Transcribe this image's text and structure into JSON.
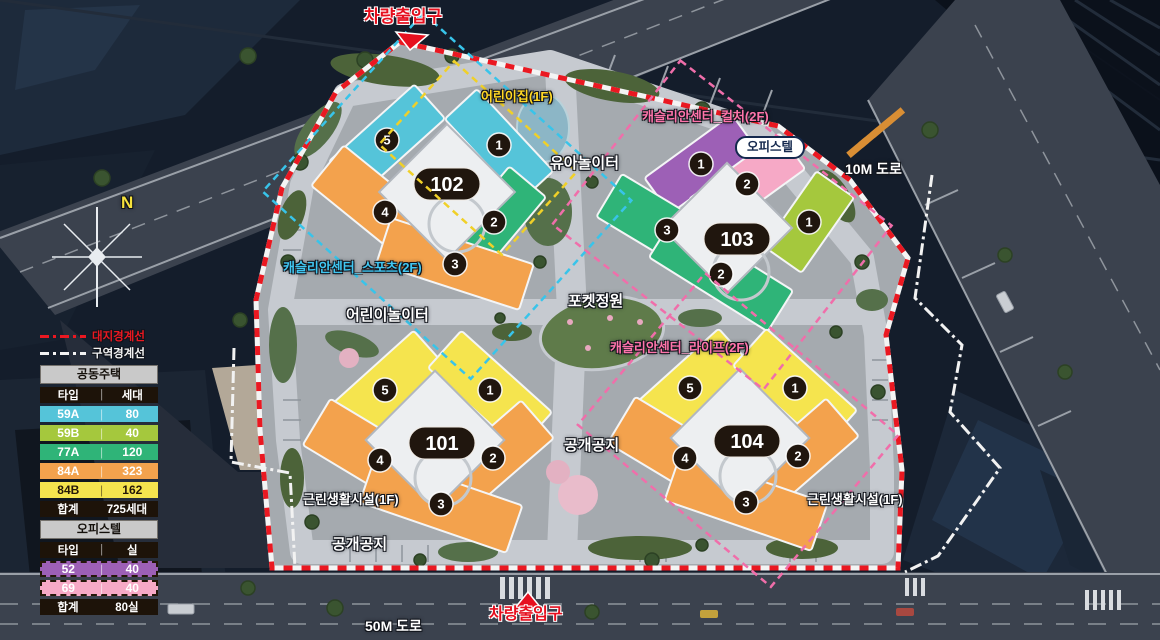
{
  "colors": {
    "type_59A": "#55c4d9",
    "type_59B": "#a5c83d",
    "type_77A": "#2fb478",
    "type_84A": "#f3a24d",
    "type_84B": "#f5e44e",
    "type_52": "#9d60b6",
    "type_69": "#f6a9c6",
    "entrance": "#e60f1e",
    "boundary_site": "#ea1821",
    "boundary_district": "#f2f2f2",
    "label_daycare": "#ffd824",
    "label_sports": "#40c7f2",
    "label_pink": "#ff74ab",
    "outline_daycare": "#f0d028",
    "outline_sports": "#38c4ea",
    "outline_culture": "#f06eaa",
    "outline_life": "#f06eaa"
  },
  "compass": {
    "n": "N"
  },
  "labels": {
    "entrance_top": "차량출입구",
    "entrance_bottom": "차량출입구",
    "daycare": "어린이집(1F)",
    "toddler_playground": "유아놀이터",
    "center_culture": "캐슬리안센터_컬처(2F)",
    "officetel_tag": "오피스텔",
    "road_10m": "10M 도로",
    "center_sports": "캐슬리안센터_스포츠(2F)",
    "kids_playground": "어린이놀이터",
    "pocket_garden": "포켓정원",
    "center_life": "캐슬리안센터_라이프(2F)",
    "open_space_center": "공개공지",
    "open_space_left": "공개공지",
    "neighborhood_left": "근린생활시설(1F)",
    "neighborhood_right": "근린생활시설(1F)",
    "road_50m": "50M 도로"
  },
  "legend": {
    "boundary_site": {
      "label": "대지경계선"
    },
    "boundary_district": {
      "label": "구역경계선"
    },
    "housing": {
      "title": "공동주택",
      "col_type": "타입",
      "col_count": "세대",
      "rows": [
        {
          "type": "59A",
          "count": "80",
          "color_key": "type_59A",
          "dark_text": false
        },
        {
          "type": "59B",
          "count": "40",
          "color_key": "type_59B",
          "dark_text": false
        },
        {
          "type": "77A",
          "count": "120",
          "color_key": "type_77A",
          "dark_text": false
        },
        {
          "type": "84A",
          "count": "323",
          "color_key": "type_84A",
          "dark_text": false
        },
        {
          "type": "84B",
          "count": "162",
          "color_key": "type_84B",
          "dark_text": true
        }
      ],
      "total_label": "합계",
      "total_value": "725세대"
    },
    "officetel": {
      "title": "오피스텔",
      "col_type": "타입",
      "col_count": "실",
      "rows": [
        {
          "type": "52",
          "count": "40",
          "color_key": "type_52",
          "dark_text": false
        },
        {
          "type": "69",
          "count": "40",
          "color_key": "type_69",
          "dark_text": false
        }
      ],
      "total_label": "합계",
      "total_value": "80실"
    }
  },
  "buildings": [
    {
      "id": "102",
      "units": [
        {
          "no": "5",
          "type": "59A"
        },
        {
          "no": "1",
          "type": "59A"
        },
        {
          "no": "4",
          "type": "84A"
        },
        {
          "no": "2",
          "type": "77A"
        },
        {
          "no": "3",
          "type": "84A"
        }
      ]
    },
    {
      "id": "103",
      "units": [
        {
          "no": "1",
          "type": "52"
        },
        {
          "no": "2",
          "type": "69"
        },
        {
          "no": "3",
          "type": "77A"
        },
        {
          "no": "2",
          "type": "77A"
        },
        {
          "no": "1",
          "type": "59B"
        }
      ]
    },
    {
      "id": "101",
      "units": [
        {
          "no": "5",
          "type": "84B"
        },
        {
          "no": "1",
          "type": "84B"
        },
        {
          "no": "4",
          "type": "84A"
        },
        {
          "no": "2",
          "type": "84A"
        },
        {
          "no": "3",
          "type": "84A"
        }
      ]
    },
    {
      "id": "104",
      "units": [
        {
          "no": "5",
          "type": "84B"
        },
        {
          "no": "1",
          "type": "84B"
        },
        {
          "no": "4",
          "type": "84A"
        },
        {
          "no": "2",
          "type": "84A"
        },
        {
          "no": "3",
          "type": "84A"
        }
      ]
    }
  ]
}
